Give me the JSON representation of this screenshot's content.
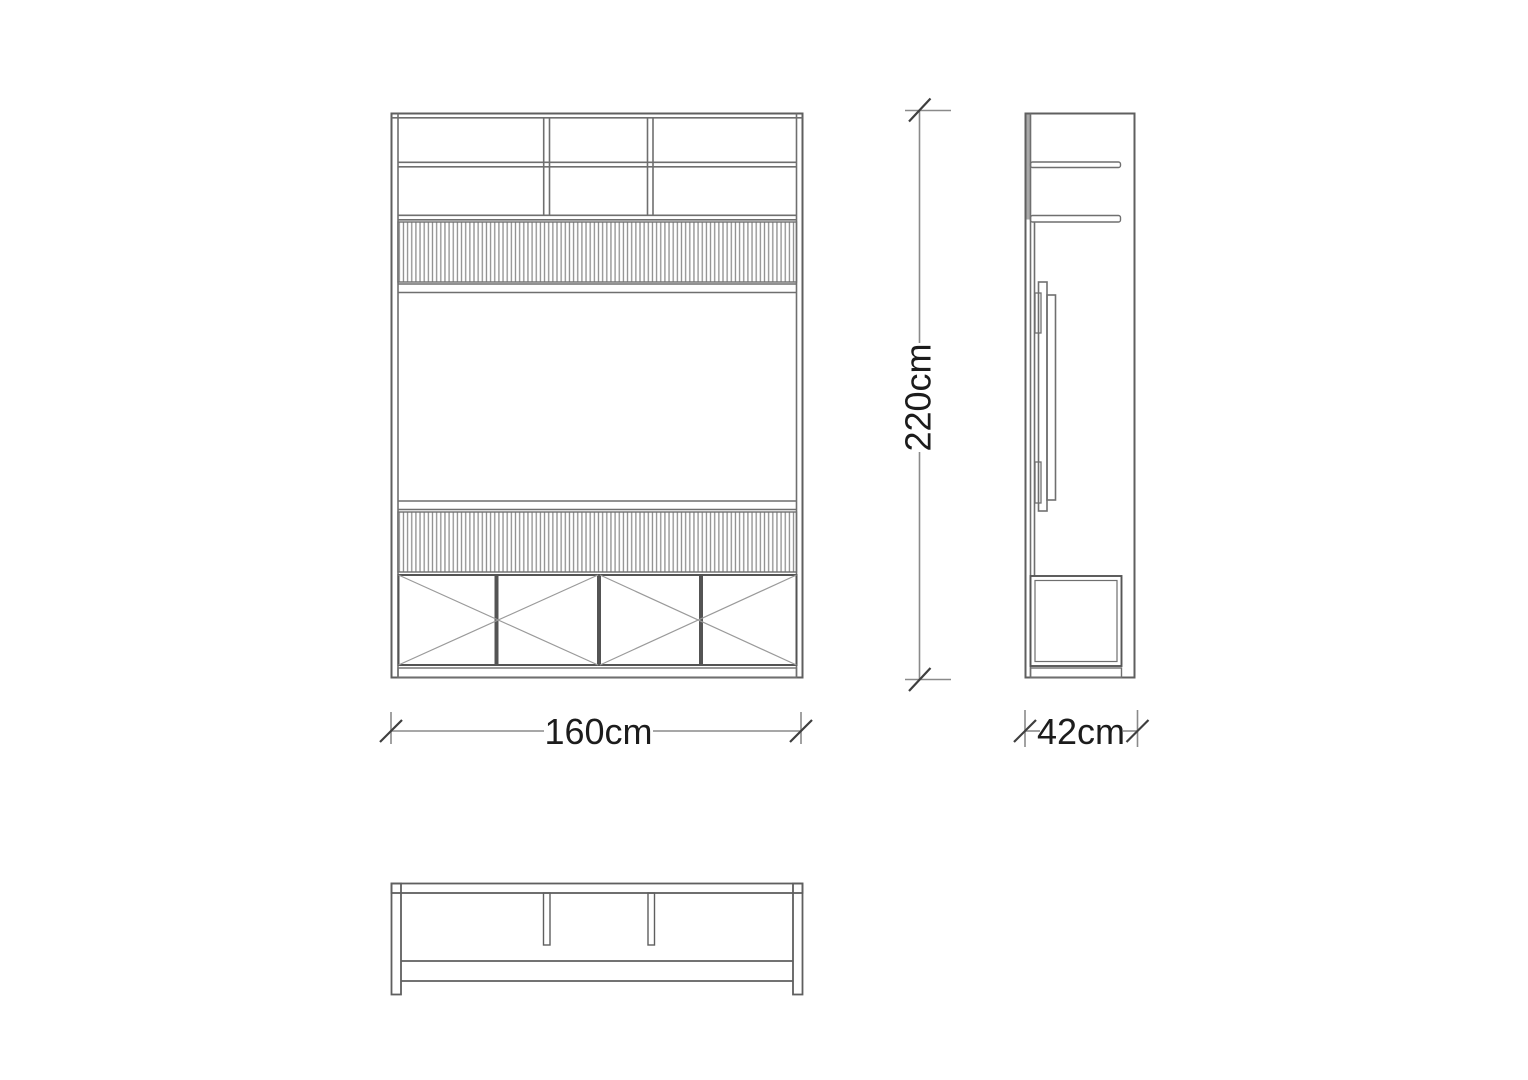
{
  "page": {
    "background": "#ffffff"
  },
  "drawing": {
    "line_color": "#6f6f6f",
    "dark_line_color": "#555555",
    "flute_stripe_color": "#8f8f8f",
    "text_color": "#1c1c1c",
    "labels": {
      "height": "220cm",
      "width": "160cm",
      "depth": "42cm"
    }
  }
}
